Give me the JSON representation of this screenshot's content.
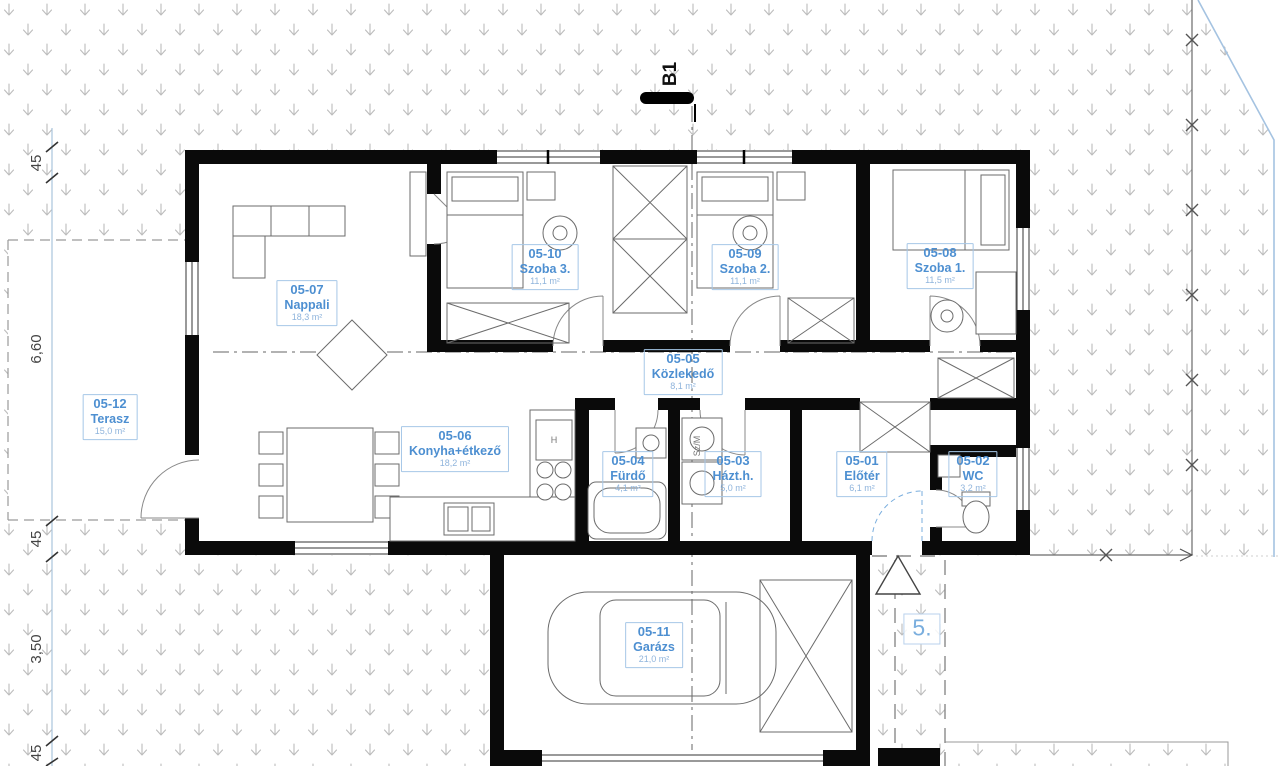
{
  "markers": {
    "section": "B1",
    "plot": "5."
  },
  "rooms": [
    {
      "id": "05-07",
      "name": "Nappali",
      "area": "18,3 m²"
    },
    {
      "id": "05-10",
      "name": "Szoba 3.",
      "area": "11,1 m²"
    },
    {
      "id": "05-09",
      "name": "Szoba 2.",
      "area": "11,1 m²"
    },
    {
      "id": "05-08",
      "name": "Szoba 1.",
      "area": "11,5 m²"
    },
    {
      "id": "05-05",
      "name": "Közlekedő",
      "area": "8,1 m²"
    },
    {
      "id": "05-06",
      "name": "Konyha+étkező",
      "area": "18,2 m²"
    },
    {
      "id": "05-04",
      "name": "Fürdő",
      "area": "4,1 m²"
    },
    {
      "id": "05-03",
      "name": "Házt.h.",
      "area": "5,0 m²"
    },
    {
      "id": "05-01",
      "name": "Előtér",
      "area": "6,1 m²"
    },
    {
      "id": "05-02",
      "name": "WC",
      "area": "3,2 m²"
    },
    {
      "id": "05-12",
      "name": "Terasz",
      "area": "15,0 m²"
    },
    {
      "id": "05-11",
      "name": "Garázs",
      "area": "21,0 m²"
    }
  ],
  "dimensions": {
    "left": [
      "45",
      "6,60",
      "45",
      "3,50",
      "45"
    ]
  },
  "equipment": {
    "washer_dryer": "Sz/M",
    "fridge": "H"
  },
  "colors": {
    "wall": "#0a0a0a",
    "label_text": "#4d8fd1",
    "label_border": "#a6c7e7",
    "area_text": "#8fb4dc",
    "grass_symbol": "#bcbcbc",
    "property_boundary": "#a5c3e1",
    "dimension_line": "#a9c4dd",
    "furniture_line": "#666666"
  }
}
